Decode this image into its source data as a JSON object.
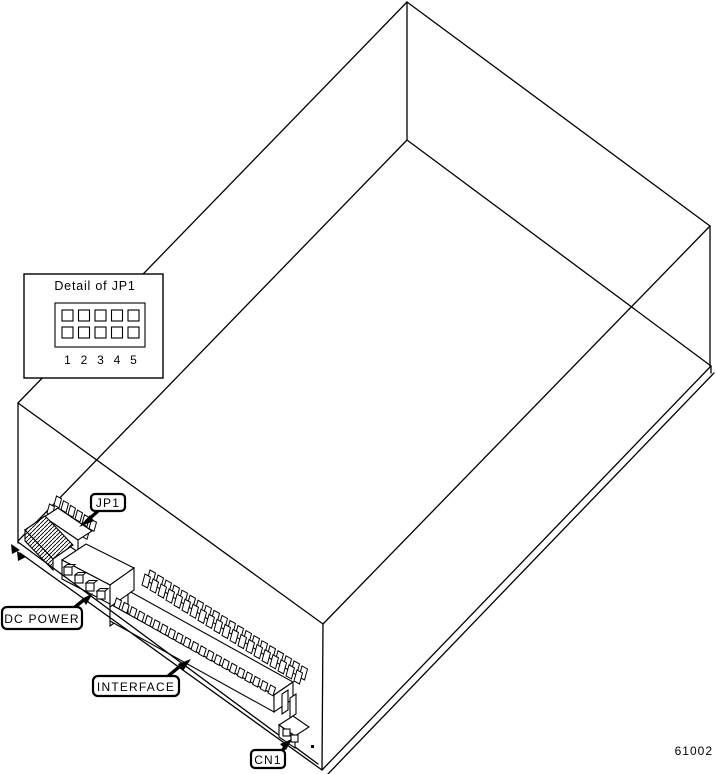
{
  "figure_number": "61002",
  "detail_inset": {
    "title": "Detail of JP1",
    "pin_grid": {
      "rows": 2,
      "cols": 5
    },
    "pin_numbers": [
      "1",
      "2",
      "3",
      "4",
      "5"
    ]
  },
  "callouts": {
    "jp1": "JP1",
    "dc_power": "DC POWER",
    "interface": "INTERFACE",
    "cn1": "CN1"
  },
  "colors": {
    "line": "#000000",
    "background": "#ffffff"
  }
}
